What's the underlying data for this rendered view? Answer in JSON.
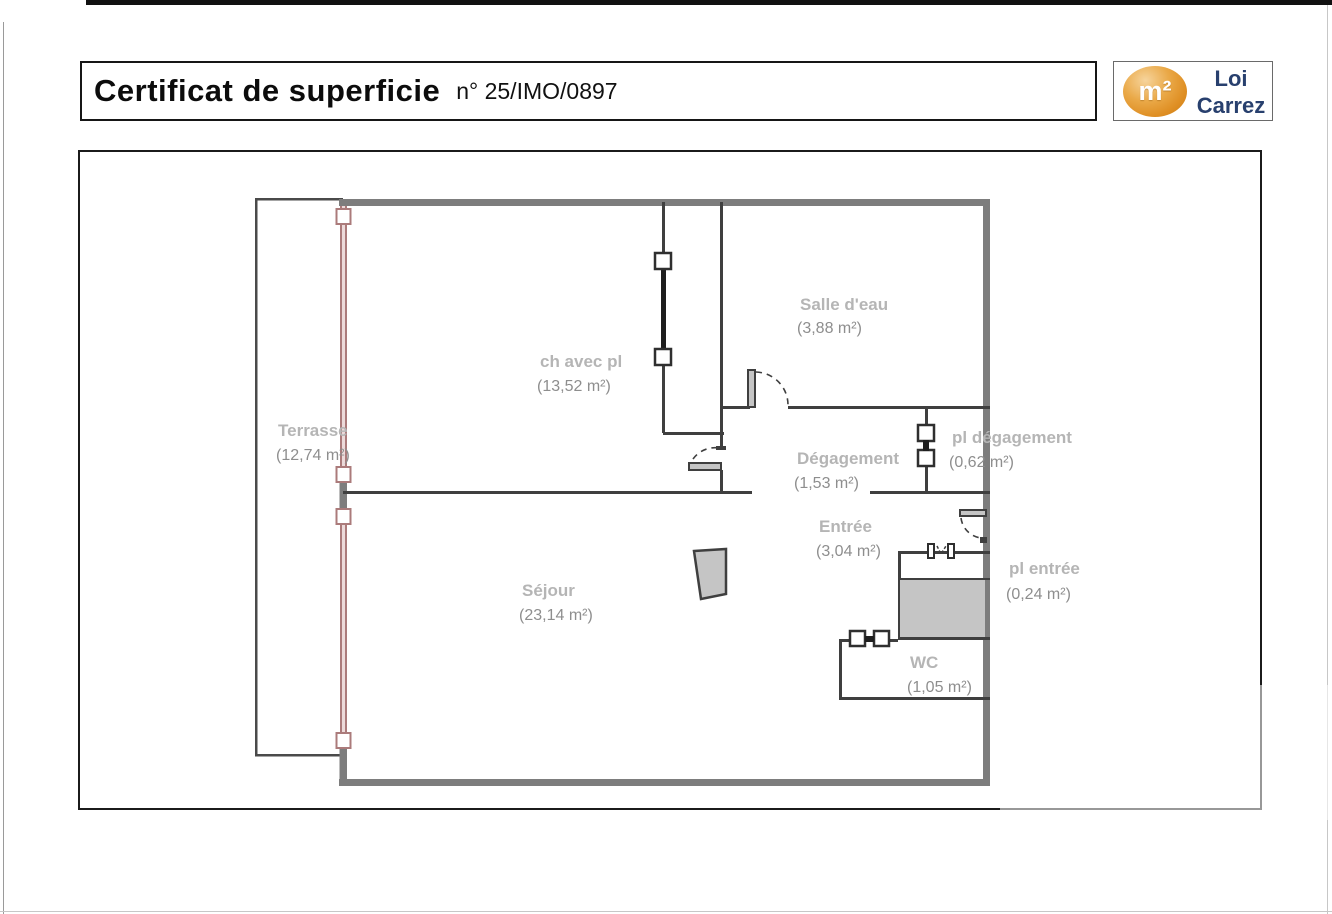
{
  "page": {
    "title": "Certificat de superficie",
    "certificate_number": "n° 25/IMO/0897"
  },
  "logo": {
    "symbol": "m²",
    "line1": "Loi",
    "line2": "Carrez",
    "colors": {
      "ellipse": "#df8f24",
      "text": "#28406e"
    }
  },
  "plan": {
    "rooms": [
      {
        "name": "Terrasse",
        "area": "(12,74 m²)"
      },
      {
        "name": "ch avec pl",
        "area": "(13,52 m²)"
      },
      {
        "name": "Salle d'eau",
        "area": "(3,88 m²)"
      },
      {
        "name": "Dégagement",
        "area": "(1,53 m²)"
      },
      {
        "name": "pl dégagement",
        "area": "(0,62 m²)"
      },
      {
        "name": "Entrée",
        "area": "(3,04 m²)"
      },
      {
        "name": "pl entrée",
        "area": "(0,24 m²)"
      },
      {
        "name": "Séjour",
        "area": "(23,14 m²)"
      },
      {
        "name": "WC",
        "area": "(1,05 m²)"
      }
    ],
    "colors": {
      "outer_wall": "#7d7d7d",
      "inner_wall": "#3f3f3f",
      "window_frame": "#ab7b7b",
      "window_glass": "#ecdada",
      "door_fill": "#c5c5c5",
      "room_name": "#b5b5b5",
      "room_area": "#8e8e8e"
    }
  }
}
